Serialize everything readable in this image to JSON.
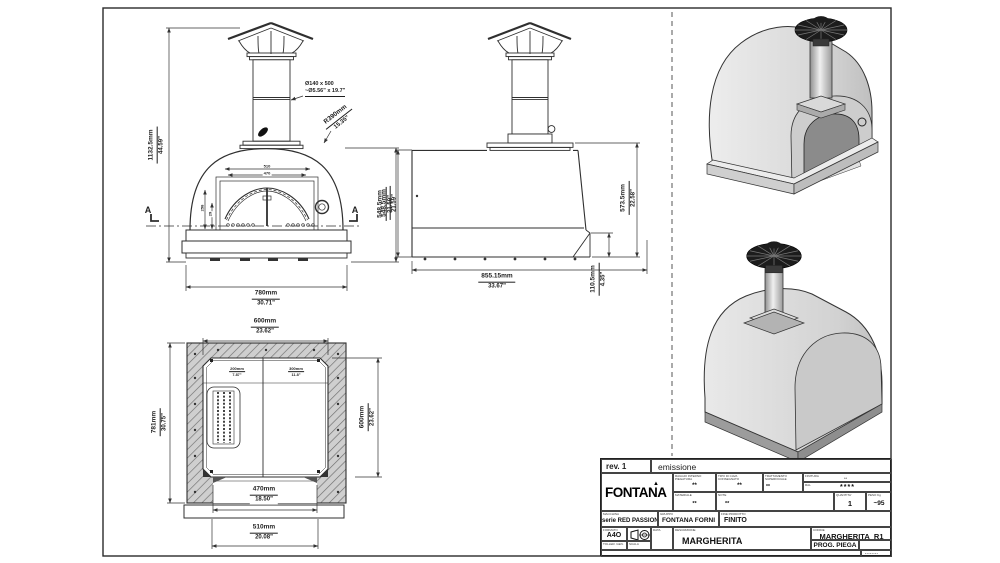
{
  "colors": {
    "line": "#333333",
    "hatch_fill": "#cccccc",
    "iso_light": "#e7e7e7",
    "iso_mid": "#c9c9c9",
    "iso_door": "#8b8b8b",
    "cap_dark": "#1c1c1c"
  },
  "front_view": {
    "chimney_note_line1": "Ø140 x 500",
    "chimney_note_line2": "~Ø5.56\" x 19.7\"",
    "dome_radius_mm": "R390mm",
    "dome_radius_in": "15.35\"",
    "overall_height_mm": "1132.5mm",
    "overall_height_in": "44.59\"",
    "body_height_mm": "548.5mm",
    "body_height_in": "21.59\"",
    "overall_width_mm": "780mm",
    "overall_width_in": "30.71\"",
    "opening_outer": "510",
    "opening_inner": "470",
    "opening_height": "258",
    "arch_rise": "29",
    "section_mark": "A"
  },
  "side_view": {
    "body_height_mm": "548.5mm",
    "body_height_in": "21.59\"",
    "total_height_mm": "573.5mm",
    "total_height_in": "22.58\"",
    "depth_mm": "855.15mm",
    "depth_in": "33.67\"",
    "ledge_height_mm": "110.5mm",
    "ledge_height_in": "4.35\""
  },
  "plan_view": {
    "inner_width_mm": "600mm",
    "inner_width_in": "23.62\"",
    "outer_depth_mm": "781mm",
    "outer_depth_in": "30.75\"",
    "inner_depth_mm": "600mm",
    "inner_depth_in": "23.62\"",
    "left_zone_mm": "200mm",
    "left_zone_in": "7.87\"",
    "right_zone_mm": "300mm",
    "right_zone_in": "11.8\"",
    "door_width_mm": "470mm",
    "door_width_in": "18.50\"",
    "front_width_mm": "510mm",
    "front_width_in": "20.08\""
  },
  "title_block": {
    "revision": "rev. 1",
    "revision_note": "emissione",
    "logo": "FONTANA",
    "spec1": {
      "label_l1": "RAGGIO INTERNO",
      "label_l2": "PIEGATURA",
      "value": "**"
    },
    "spec2": {
      "label_l1": "TIPO DI CAVA",
      "label_l2": "CONSEGNATO",
      "value": "**"
    },
    "spec3": {
      "label_l1": "TRATTAMENTO",
      "label_l2": "SUPERFICIALE",
      "value": "**"
    },
    "finish": {
      "label": "FINITURA",
      "sub": "RAL",
      "sub_value": "**",
      "value": "****"
    },
    "material": {
      "label": "MATERIALE",
      "value": "**"
    },
    "note": {
      "label": "NOTE",
      "value": "**"
    },
    "quantity": {
      "label": "QUANTITA'",
      "value": "1"
    },
    "weight": {
      "label": "PESO Kg",
      "value": "~95"
    },
    "machine": {
      "label": "MACCHINA",
      "value": "serie RED PASSION"
    },
    "group": {
      "label": "GRUPPO",
      "value": "FONTANA FORNI"
    },
    "end_product": {
      "label": "FINE PRODOTTO",
      "value": "FINITO"
    },
    "format": {
      "label": "FORMATO",
      "value": "A4O"
    },
    "tolerance_label": "TOLLER. GEN.",
    "scale_label": "SCALA",
    "date_label": "DATA",
    "description": {
      "label": "DESCRIZIONE",
      "value": "MARGHERITA"
    },
    "code": {
      "label": "CODICE",
      "value": "MARGHERITA_R1"
    },
    "prog": "PROG. PIEGA",
    "disclaimer": "Questo disegno è proprietà riservata di FONTANA: vietata ogni riproduzione o divulgazione a terze parti se non autorizzata.",
    "stamp": "********"
  }
}
